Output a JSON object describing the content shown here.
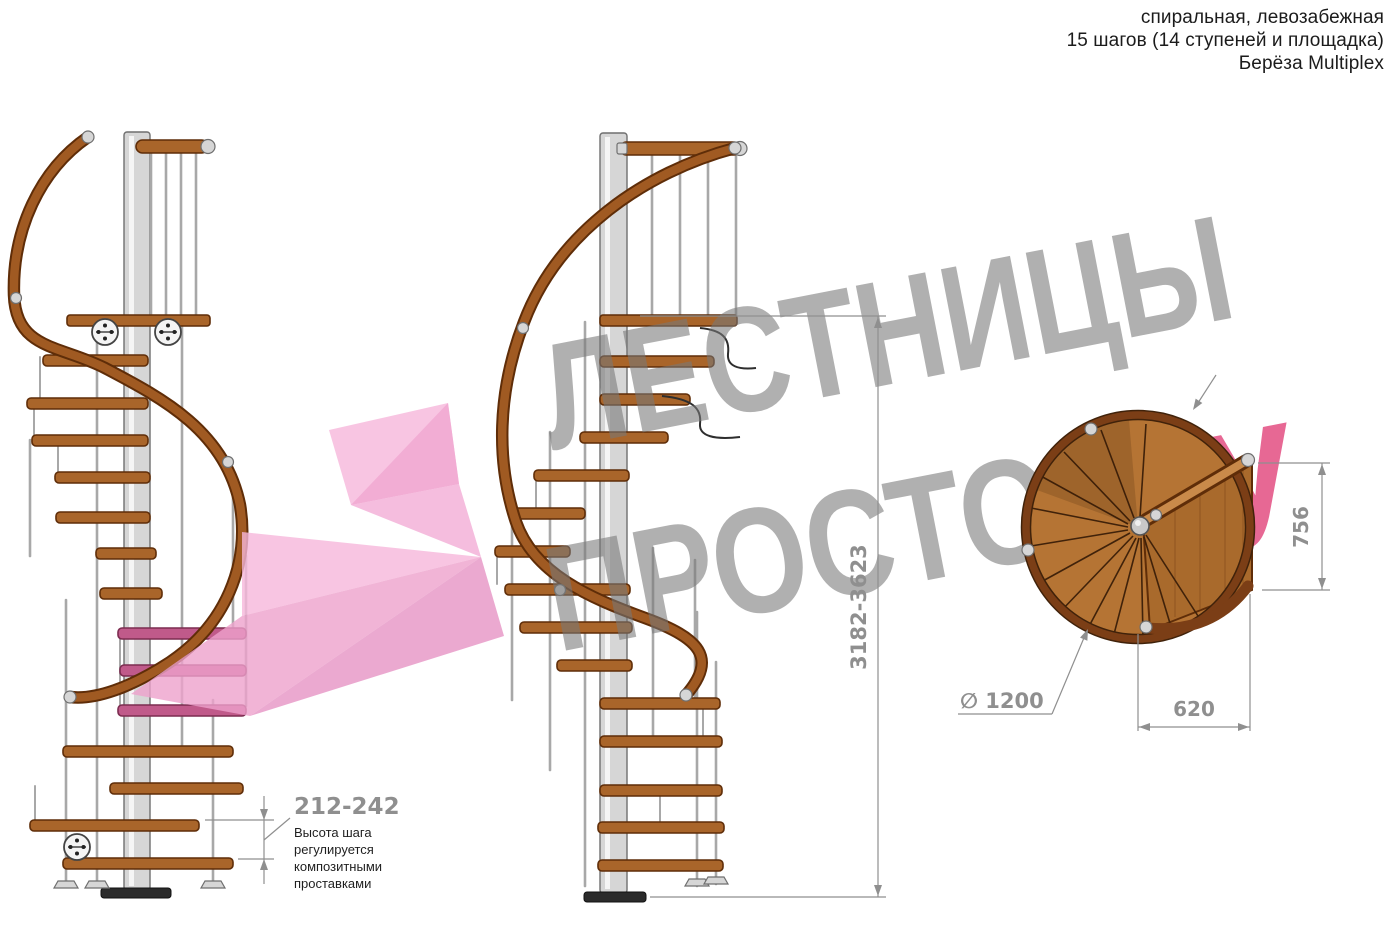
{
  "header": {
    "line1": "спиральная, левозабежная",
    "line2": "15 шагов (14 ступеней и площадка)",
    "line3": "Берёза Multiplex"
  },
  "watermark": {
    "word1": "ЛЕСТНИЦЫ",
    "word2_gray": "ПРОСТО",
    "word2_pink": ".ру"
  },
  "dimensions": {
    "total_height": "3182-3623",
    "step_height": "212-242",
    "landing_depth": "756",
    "landing_width": "620",
    "diameter": "∅ 1200",
    "note_line1": "Высота шага",
    "note_line2": "регулируется",
    "note_line3": "композитными",
    "note_line4": "проставками"
  },
  "colors": {
    "wood": "#a9652a",
    "wood_dark": "#5f2d08",
    "rail": "#a05a22",
    "steel": "#d6d6d6",
    "steel_mid": "#a8a8a8",
    "steel_dark": "#6f6f6f",
    "dim": "#8f8f8f",
    "note": "#1f1f1f",
    "wm_gray": "#787878",
    "wm_pink": "#e2477d",
    "logo_pink": "#f2aed6",
    "plan_wood": "#b57434",
    "plan_rim": "#7b3e16"
  }
}
